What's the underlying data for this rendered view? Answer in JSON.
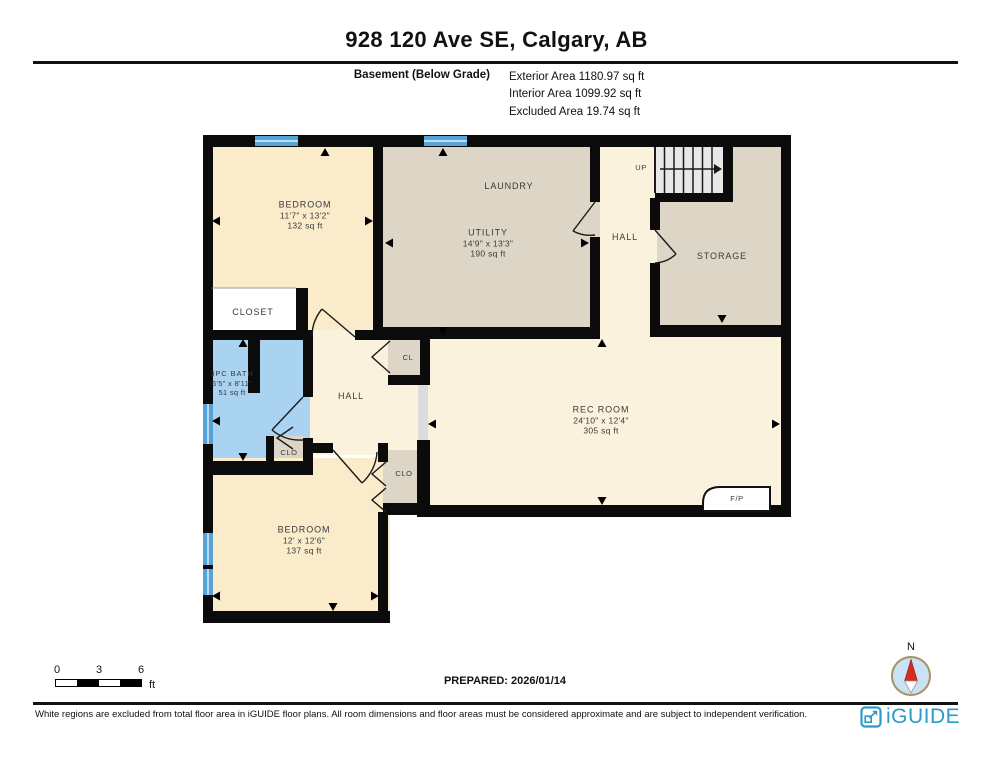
{
  "header": {
    "title": "928 120 Ave SE, Calgary, AB",
    "floor_label": "Basement (Below Grade)",
    "areas": {
      "exterior": "Exterior Area 1180.97 sq ft",
      "interior": "Interior Area 1099.92 sq ft",
      "excluded": "Excluded Area 19.74 sq ft"
    }
  },
  "rooms": {
    "bedroom1": {
      "name": "BEDROOM",
      "dims": "11'7\" x 13'2\"",
      "area": "132 sq ft"
    },
    "closet1": {
      "name": "CLOSET"
    },
    "laundry": {
      "name": "LAUNDRY"
    },
    "utility": {
      "name": "UTILITY",
      "dims": "14'9\" x 13'3\"",
      "area": "190 sq ft"
    },
    "hall_top": {
      "name": "HALL"
    },
    "stairs": {
      "name": "UP"
    },
    "storage": {
      "name": "STORAGE"
    },
    "bath": {
      "name": "3PC BATH",
      "dims": "6'5\" x 8'11\"",
      "area": "51 sq ft"
    },
    "clo_bath": {
      "name": "CLO"
    },
    "hall_mid": {
      "name": "HALL"
    },
    "cl": {
      "name": "CL"
    },
    "clo_bottom": {
      "name": "CLO"
    },
    "rec_room": {
      "name": "REC ROOM",
      "dims": "24'10\" x 12'4\"",
      "area": "305 sq ft"
    },
    "fireplace": {
      "name": "F/P"
    },
    "bedroom2": {
      "name": "BEDROOM",
      "dims": "12' x 12'6\"",
      "area": "137 sq ft"
    }
  },
  "scale_bar": {
    "tick0": "0",
    "tick1": "3",
    "tick2": "6",
    "unit": "ft"
  },
  "prepared": "PREPARED: 2026/01/14",
  "compass": {
    "north_label": "N"
  },
  "footer": {
    "disclaimer": "White regions are excluded from total floor area in iGUIDE floor plans. All room dimensions and floor areas must be considered approximate and are subject to independent verification.",
    "brand": "iGUIDE"
  },
  "colors": {
    "wall": "#0b0b0b",
    "bedroom_fill": "#FAECCB",
    "hall_fill": "#FAF2DC",
    "utility_fill": "#DDD6C6",
    "bath_fill": "#A9D3F1",
    "window_blue": "#55A4D9",
    "stair_fill": "#E8E8E8",
    "logo_blue": "#2B9AC6"
  }
}
